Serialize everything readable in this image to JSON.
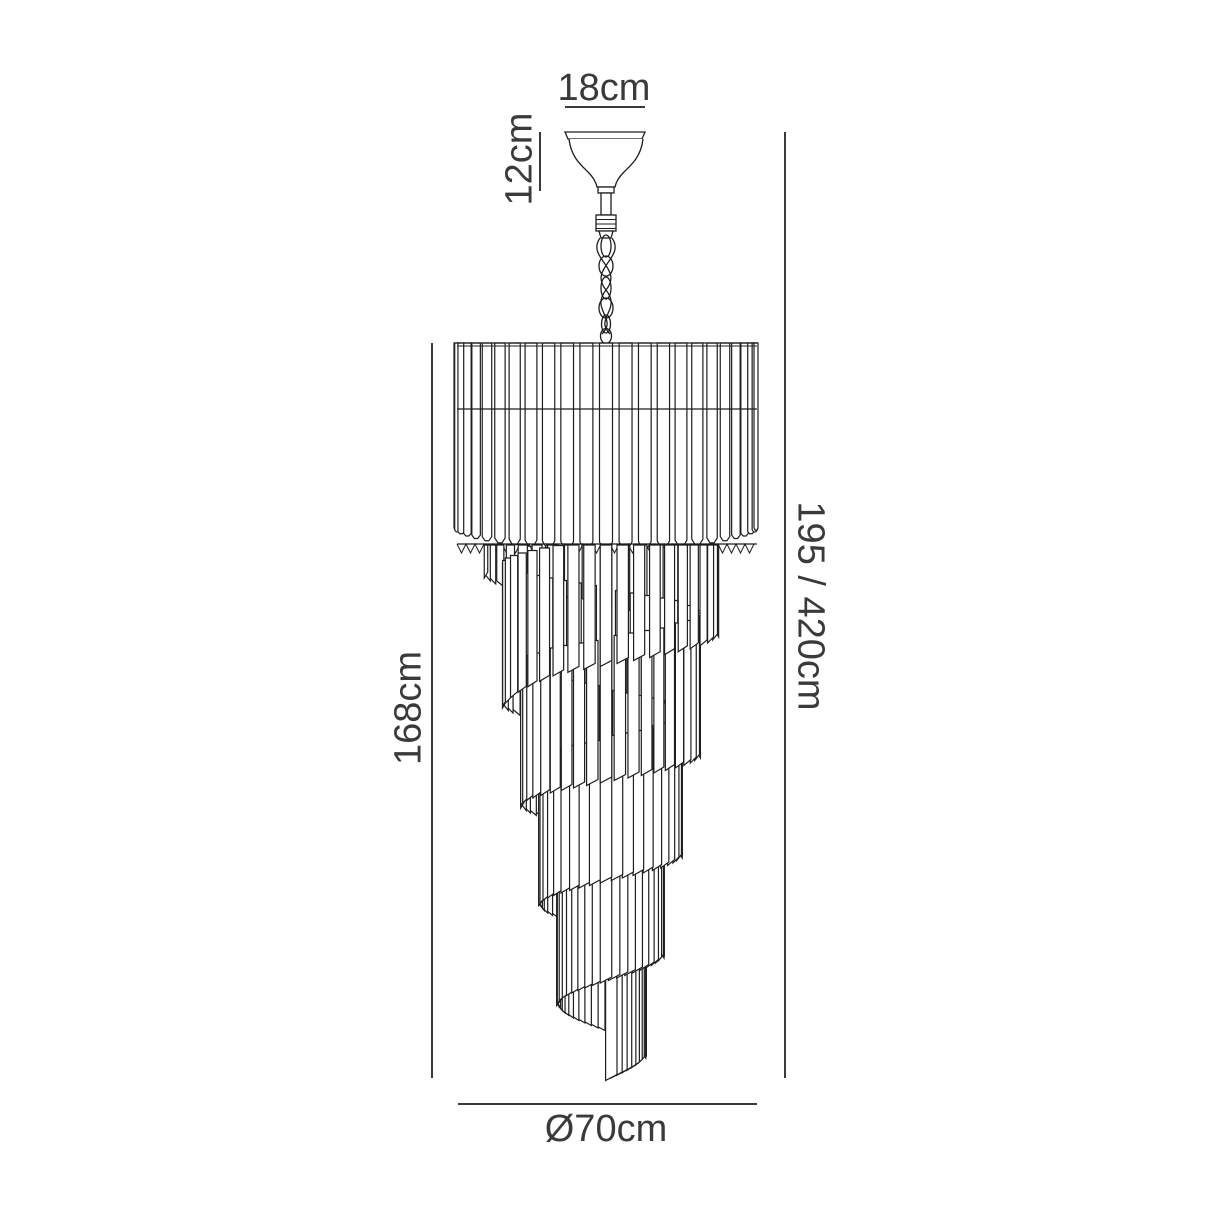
{
  "diagram": {
    "kind": "product-dimension-drawing",
    "product": "spiral tiered crystal chandelier"
  },
  "labels": {
    "canopy_width": "18cm",
    "canopy_height": "12cm",
    "body_height": "168cm",
    "overall_height": "195 / 420cm",
    "diameter": "Ø70cm"
  },
  "colors": {
    "background": "#ffffff",
    "drawing_line": "#1e1e1e",
    "dimension_line": "#3a3a3a",
    "text": "#3a3a3a"
  },
  "drawing": {
    "canvas": {
      "width": 1214,
      "height": 1214
    },
    "center_x": 606,
    "drum": {
      "left": 457,
      "right": 757,
      "top": 343,
      "top_line2": 346,
      "band_line_y": 409,
      "rod_bottom": 528,
      "bulge": 14,
      "ring_y": 544,
      "rod_count": 25
    },
    "spiral": {
      "top_y": 545,
      "wraps": 4.72,
      "rods_per_wrap": 40,
      "radius_start": 120,
      "radius_end": 34,
      "drop_per_wrap": 100,
      "drop_delay": 0.82,
      "len_max": 142,
      "len_base": 30,
      "len_grow": 118,
      "phase_deg": -90,
      "tip_slant": 3
    },
    "dim_lines": {
      "d18": {
        "y": 107,
        "x1": 565,
        "x2": 645
      },
      "d12": {
        "x": 540,
        "y1": 132,
        "y2": 191
      },
      "left": {
        "x": 432,
        "y1": 343,
        "y2": 1078
      },
      "right": {
        "x": 785,
        "y1": 132,
        "y2": 1078
      },
      "bottom": {
        "y": 1104,
        "x1": 458,
        "x2": 757
      }
    },
    "text_pos": {
      "d18": {
        "x": 604,
        "y": 100
      },
      "d12": {
        "x": 518,
        "y": 159,
        "rotate": -90
      },
      "left": {
        "x": 407,
        "y": 708,
        "rotate": -90
      },
      "right": {
        "x": 812,
        "y": 606,
        "rotate": 90
      },
      "bottom": {
        "x": 606,
        "y": 1141
      }
    }
  }
}
